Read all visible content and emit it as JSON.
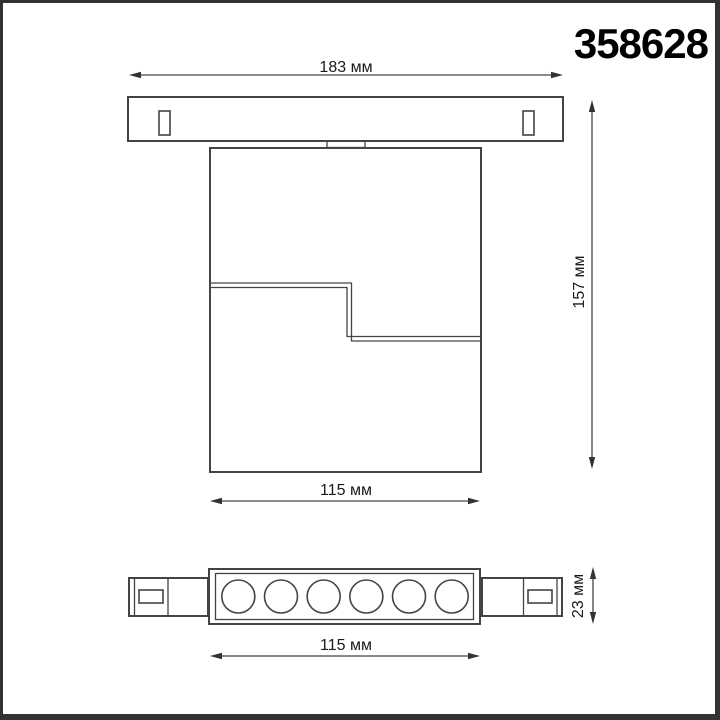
{
  "product": {
    "code": "358628"
  },
  "dimensions": {
    "track_width": "183 мм",
    "overall_height": "157 мм",
    "body_width": "115 мм",
    "module_height": "23 мм",
    "module_width": "115 мм"
  },
  "bottom_view": {
    "lens_count": 6
  },
  "colors": {
    "line": "#444444",
    "label_text": "#1a1a1a",
    "product_code_text": "#000000",
    "frame_border": "#333333",
    "background": "#ffffff"
  }
}
